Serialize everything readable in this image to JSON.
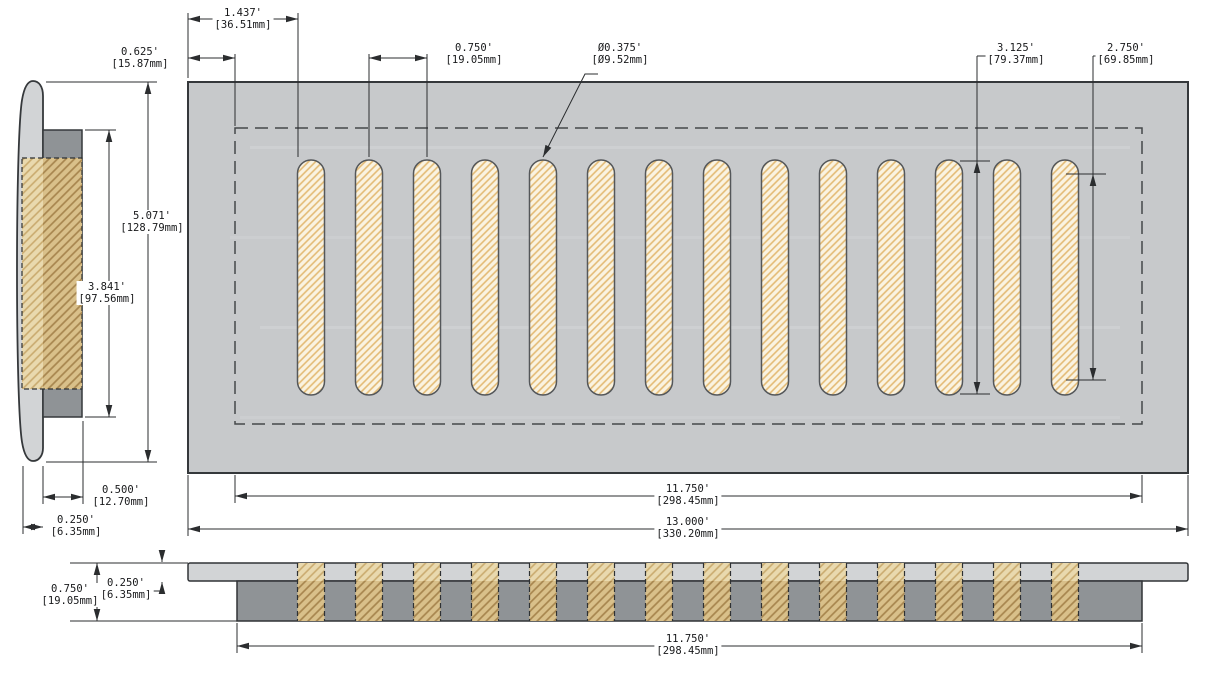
{
  "drawing_type": "vent-register-3-view-dimensioned-drawing",
  "colors": {
    "plate_gray": "#c7c9cb",
    "faceplate_gray": "#d2d4d6",
    "duct_gray": "#8f9396",
    "slot_cream": "#faf3e1",
    "slot_hatch": "#e3ba74",
    "tan": "#d9c08a",
    "tan_hatch": "#a7854e",
    "tan_light": "#e9d9ae",
    "tan_light_hatch": "#c9aa6e",
    "line": "#2b2d2f",
    "outline": "#35383b"
  },
  "slots": {
    "count": 14
  },
  "dimensions": {
    "first_slot_offset": {
      "in": "1.437'",
      "mm": "[36.51mm]"
    },
    "flange_inset": {
      "in": "0.625'",
      "mm": "[15.87mm]"
    },
    "slot_pitch": {
      "in": "0.750'",
      "mm": "[19.05mm]"
    },
    "slot_width_dia": {
      "in": "Ø0.375'",
      "mm": "[Ø9.52mm]"
    },
    "slot_length": {
      "in": "3.125'",
      "mm": "[79.37mm]"
    },
    "slot_straight_length": {
      "in": "2.750'",
      "mm": "[69.85mm]"
    },
    "faceplate_height": {
      "in": "5.071'",
      "mm": "[128.79mm]"
    },
    "duct_opening_height": {
      "in": "3.841'",
      "mm": "[97.56mm]"
    },
    "duct_depth": {
      "in": "0.500'",
      "mm": "[12.70mm]"
    },
    "faceplate_thickness": {
      "in": "0.250'",
      "mm": "[6.35mm]"
    },
    "duct_opening_width": {
      "in": "11.750'",
      "mm": "[298.45mm]"
    },
    "faceplate_width": {
      "in": "13.000'",
      "mm": "[330.20mm]"
    },
    "profile_total_depth": {
      "in": "0.750'",
      "mm": "[19.05mm]"
    },
    "profile_plate_thickness": {
      "in": "0.250'",
      "mm": "[6.35mm]"
    },
    "profile_duct_width": {
      "in": "11.750'",
      "mm": "[298.45mm]"
    }
  }
}
